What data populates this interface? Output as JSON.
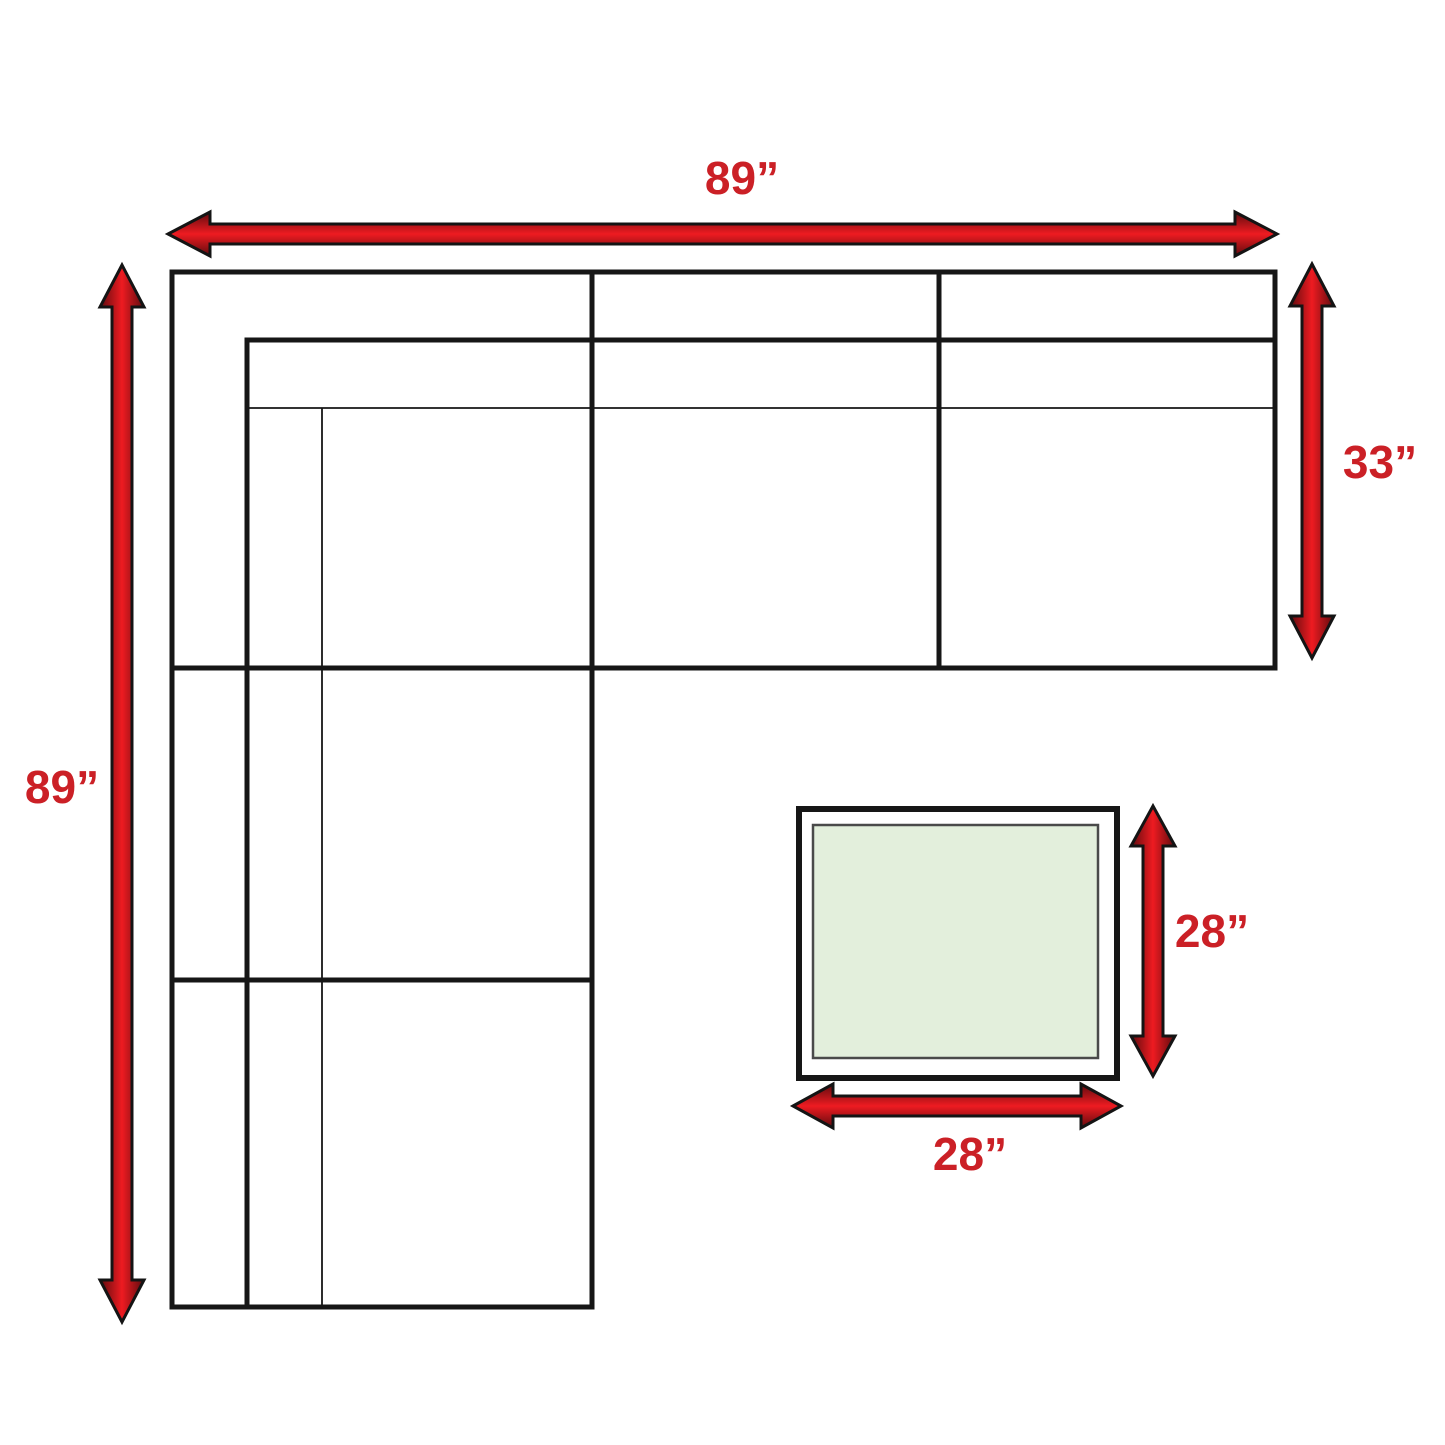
{
  "diagram": {
    "title": "Sectional sofa with ottoman - dimension diagram (top view)",
    "sofa": {
      "overall_width_label": "89”",
      "overall_depth_label": "89”",
      "section_depth_label": "33”"
    },
    "ottoman": {
      "depth_label": "28”",
      "width_label": "28”"
    },
    "colors": {
      "background": "#ffffff",
      "line_black": "#161616",
      "label_red": "#cb2026",
      "arrow_red_bright": "#ee1b21",
      "arrow_red_dark": "#5e0b0e",
      "ottoman_fill": "#e3efdc",
      "ottoman_border": "#4a4a4a"
    }
  }
}
